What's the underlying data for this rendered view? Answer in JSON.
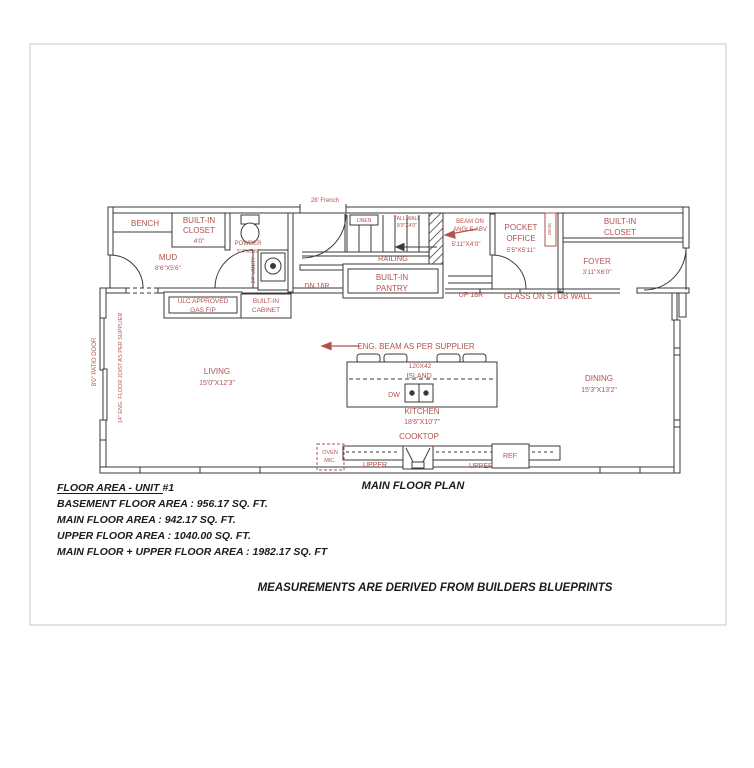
{
  "sheet": {
    "plan_title": "MAIN FLOOR PLAN",
    "disclaimer": "MEASUREMENTS ARE DERIVED FROM BUILDERS BLUEPRINTS",
    "area_summary": {
      "heading": "FLOOR AREA - UNIT #1",
      "basement": "BASEMENT FLOOR AREA : 956.17 SQ. FT.",
      "main": "MAIN FLOOR AREA : 942.17 SQ. FT.",
      "upper": "UPPER FLOOR AREA : 1040.00 SQ. FT.",
      "combined": "MAIN FLOOR + UPPER FLOOR AREA : 1982.17 SQ. FT"
    }
  },
  "rooms": {
    "mud": {
      "name": "MUD",
      "dims": "8'6\"X5'6\""
    },
    "powder": {
      "name": "POWDER",
      "dims": "5'4\"X5'6\""
    },
    "living": {
      "name": "LIVING",
      "dims": "15'0\"X12'3\""
    },
    "dining": {
      "name": "DINING",
      "dims": "15'3\"X13'2\""
    },
    "kitchen": {
      "name": "KITCHEN",
      "dims": "18'6\"X10'7\""
    },
    "pocket_office": {
      "line1": "POCKET",
      "line2": "OFFICE",
      "dims": "5'5\"X5'11\""
    },
    "foyer": {
      "name": "FOYER",
      "dims": "3'11\"X6'0\""
    }
  },
  "features": {
    "bench": "BENCH",
    "closet_left": {
      "line1": "BUILT-IN",
      "line2": "CLOSET",
      "dims": "4'0\""
    },
    "closet_right": {
      "line1": "BUILT-IN",
      "line2": "CLOSET"
    },
    "vanity": "24\" VANITY",
    "gas_fp": {
      "line1": "ULC APPROVED",
      "line2": "GAS F/P"
    },
    "cabinet": {
      "line1": "BUILT-IN",
      "line2": "CABINET"
    },
    "pantry": {
      "line1": "BUILT-IN",
      "line2": "PANTRY"
    },
    "railing": "RAILING",
    "stair_down": "DN 16R",
    "stair_up": "UP 18R",
    "linen": "LINEN",
    "tall_wall": {
      "line1": "TALL WALL",
      "line2": "8'9\"X4'0\""
    },
    "beam_angle": {
      "line1": "BEAM ON",
      "line2": "ANGLE ABV",
      "dims": "5'11\"X4'0\""
    },
    "glass_stub": "GLASS ON STUB WALL",
    "french_door": "28' French",
    "desk": "DESK",
    "eng_beam": "ENG. BEAM AS PER SUPPLIER",
    "island": {
      "size": "120X42",
      "label": "ISLAND",
      "dishwasher": "DW"
    },
    "cooktop": "COOKTOP",
    "oven_mic": {
      "line1": "OVEN",
      "line2": "MIC."
    },
    "upper_cab_left": "UPPER",
    "upper_cab_right": "UPPER",
    "fridge": "REF",
    "patio_door": "8'0\" PATIO DOOR",
    "floor_joist": "14\" ENG. FLOOR JOIST AS PER SUPPLIER"
  },
  "colors": {
    "annotation_red": "#b0524e",
    "line_dark": "#3a3a3a",
    "sheet_border": "#c4c4c4",
    "background": "#ffffff"
  }
}
